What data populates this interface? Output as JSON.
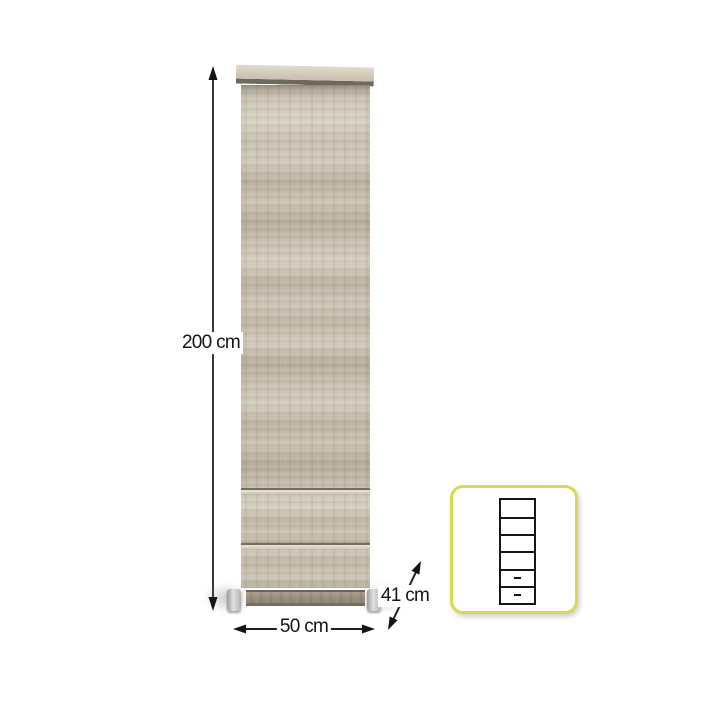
{
  "dimensions": {
    "height": {
      "label": "200 cm"
    },
    "width": {
      "label": "50 cm"
    },
    "depth": {
      "label": "41 cm"
    }
  },
  "schematic": {
    "compartments": [
      {
        "type": "shelf",
        "rel_height": 20
      },
      {
        "type": "shelf",
        "rel_height": 18
      },
      {
        "type": "shelf",
        "rel_height": 19
      },
      {
        "type": "shelf",
        "rel_height": 19
      },
      {
        "type": "drawer",
        "rel_height": 15
      },
      {
        "type": "drawer",
        "rel_height": 16
      }
    ]
  },
  "colors": {
    "background": "#ffffff",
    "annotation_line": "#3a3a3a",
    "annotation_text": "#141414",
    "highlight_box_border": "#d9d94f",
    "schematic_line": "#151515",
    "wood_light": "#d6cfc1",
    "wood_mid": "#c8bfb0",
    "wood_dark": "#b5aa99",
    "plinth": "#9c9181",
    "foot": "#c6c6c6"
  }
}
